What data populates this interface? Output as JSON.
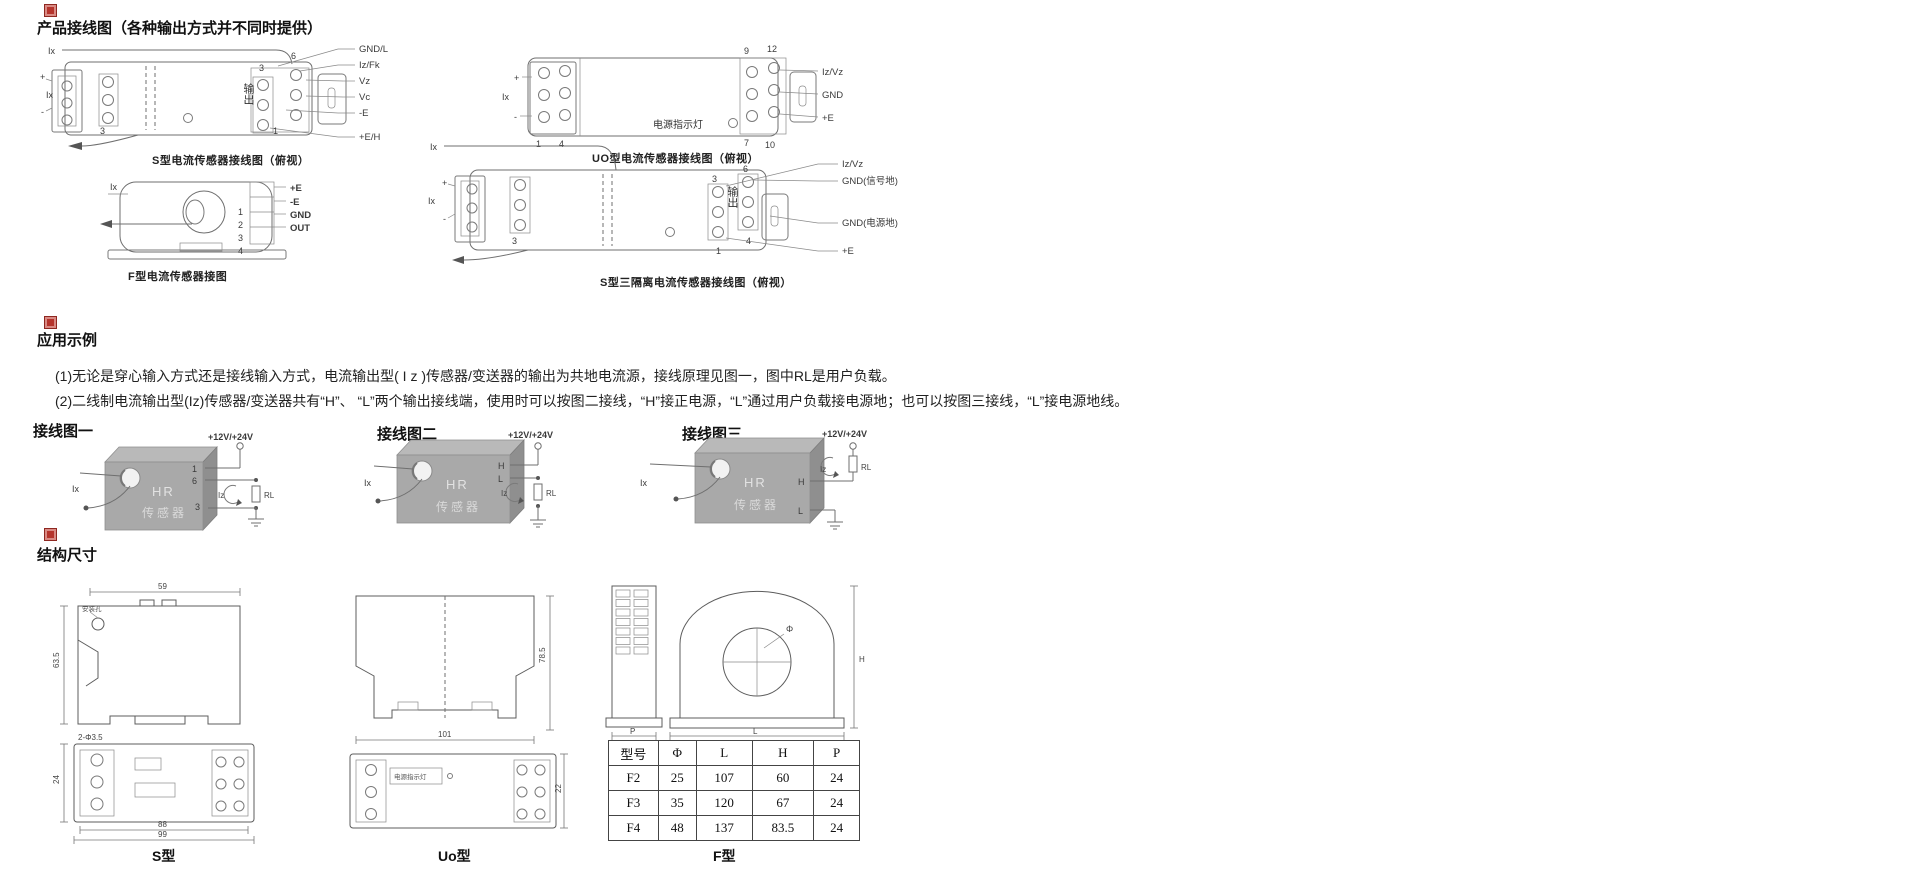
{
  "wiring_section": {
    "title": "产品接线图（各种输出方式并不同时提供）",
    "s_diagram": {
      "caption": "S型电流传感器接线图（俯视）",
      "ix_top": "Ix",
      "plus": "+",
      "ix_left": "Ix",
      "minus": "-",
      "pin3_inner": "3",
      "output_label": "输出",
      "pin3": "3",
      "pin6": "6",
      "pin1": "1",
      "labels": [
        "GND/L",
        "Iz/Fk",
        "Vz",
        "Vc",
        "-E",
        "+E/H"
      ]
    },
    "f_diagram": {
      "caption": "F型电流传感器接图",
      "ix": "Ix",
      "pins": [
        "1",
        "2",
        "3",
        "4"
      ],
      "labels": [
        "+E",
        "-E",
        "GND",
        "OUT"
      ]
    },
    "uo_diagram": {
      "caption": "UO型电流传感器接线图（俯视）",
      "ix": "Ix",
      "plus": "+",
      "minus": "-",
      "pin1": "1",
      "pin4": "4",
      "power_led": "电源指示灯",
      "pin9": "9",
      "pin12": "12",
      "pin7": "7",
      "pin10": "10",
      "labels": [
        "Iz/Vz",
        "GND",
        "+E"
      ]
    },
    "s3_diagram": {
      "caption": "S型三隔离电流传感器接线图（俯视）",
      "ix_top": "Ix",
      "plus": "+",
      "ix_left": "Ix",
      "minus": "-",
      "pin3_inner": "3",
      "output_label": "输出",
      "pin3": "3",
      "pin6": "6",
      "pin1": "1",
      "pin4": "4",
      "labels": [
        "Iz/Vz",
        "GND(信号地)",
        "GND(电源地)",
        "+E"
      ]
    }
  },
  "application_section": {
    "title": "应用示例",
    "para1": "(1)无论是穿心输入方式还是接线输入方式，电流输出型( I z )传感器/变送器的输出为共地电流源，接线原理见图一，图中RL是用户负载。",
    "para2": "(2)二线制电流输出型(Iz)传感器/变送器共有“H”、 “L”两个输出接线端，使用时可以按图二接线，“H”接正电源，“L”通过用户负载接电源地；也可以按图三接线，“L”接电源地线。",
    "figures": [
      {
        "label": "接线图一",
        "supply": "+12V/+24V",
        "ix": "Ix",
        "device_line1": "HR",
        "device_line2": "传感器",
        "pin_a": "1",
        "pin_b": "6",
        "pin_c": "3",
        "iz": "Iz",
        "rl": "RL"
      },
      {
        "label": "接线图二",
        "supply": "+12V/+24V",
        "ix": "Ix",
        "device_line1": "HR",
        "device_line2": "传感器",
        "pin_a": "H",
        "pin_b": "L",
        "iz": "Iz",
        "rl": "RL"
      },
      {
        "label": "接线图三",
        "supply": "+12V/+24V",
        "ix": "Ix",
        "device_line1": "HR",
        "device_line2": "传感器",
        "pin_a": "H",
        "pin_b": "L",
        "iz": "Iz",
        "rl": "RL"
      }
    ]
  },
  "dimensions_section": {
    "title": "结构尺寸",
    "s_drawing": {
      "caption": "S型",
      "dim_top": "59",
      "dim_left": "63.5",
      "hole_label": "安装孔",
      "dim_holes": "2-Φ3.5",
      "dim_side": "24",
      "dim_l1": "88",
      "dim_l2": "99"
    },
    "uo_drawing": {
      "caption": "Uo型",
      "dim_height": "78.5",
      "dim_length": "101",
      "dim_side": "22",
      "power_led": "电源指示灯"
    },
    "f_drawing": {
      "caption": "F型",
      "dim_p": "P",
      "dim_phi": "Φ",
      "dim_h": "H",
      "dim_l": "L"
    },
    "table": {
      "headers": [
        "型号",
        "Φ",
        "L",
        "H",
        "P"
      ],
      "rows": [
        [
          "F2",
          "25",
          "107",
          "60",
          "24"
        ],
        [
          "F3",
          "35",
          "120",
          "67",
          "24"
        ],
        [
          "F4",
          "48",
          "137",
          "83.5",
          "24"
        ]
      ]
    }
  }
}
